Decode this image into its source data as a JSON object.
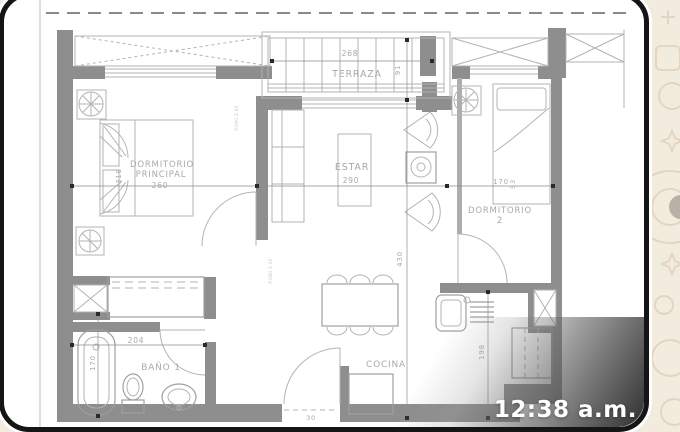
{
  "wallpaper": {
    "bg": "#f2ecdf",
    "doodle_color": "#e3d5c0",
    "accent_circle_color": "#b8b1a6"
  },
  "card": {
    "bg": "#ffffff",
    "border_color": "#151515"
  },
  "overlay": {
    "timestamp": "12:38 a.m.",
    "text_color": "#ffffff"
  },
  "plan": {
    "wall_color": "#8e8e8e",
    "label_color": "#a9a9a9",
    "rooms": [
      {
        "name": "DORMITORIO PRINCIPAL",
        "width_cm": "260",
        "depth_cm": "318"
      },
      {
        "name": "TERRAZA",
        "width_cm": "268",
        "depth_cm": "91"
      },
      {
        "name": "ESTAR",
        "width_cm": "290",
        "length_cm": "430"
      },
      {
        "name": "DORMITORIO 2",
        "width_cm": "170",
        "extra_cm": "53"
      },
      {
        "name": "BAÑO 1",
        "width_cm": "204",
        "depth_cm": "170"
      },
      {
        "name": "COCINA",
        "depth_cm": "198"
      }
    ],
    "labels": [
      {
        "id": "terraza-name",
        "t": "TERRAZA",
        "x": 357,
        "y": 77,
        "s": 9.5
      },
      {
        "id": "terraza-width",
        "t": "268",
        "x": 350,
        "y": 56,
        "s": 7.5
      },
      {
        "id": "terraza-depth",
        "t": "91",
        "x": 400,
        "y": 70,
        "s": 7,
        "r": -90
      },
      {
        "id": "dorm1-line1",
        "t": "DORMITORIO",
        "x": 162,
        "y": 167,
        "s": 8.5
      },
      {
        "id": "dorm1-line2",
        "t": "PRINCIPAL",
        "x": 161,
        "y": 177,
        "s": 8.5
      },
      {
        "id": "dorm1-width",
        "t": "260",
        "x": 160,
        "y": 188,
        "s": 7.5
      },
      {
        "id": "dorm1-depth",
        "t": "318",
        "x": 121,
        "y": 176,
        "s": 7,
        "r": -90
      },
      {
        "id": "estar-name",
        "t": "ESTAR",
        "x": 352,
        "y": 170,
        "s": 9.5
      },
      {
        "id": "estar-width",
        "t": "290",
        "x": 351,
        "y": 183,
        "s": 7.5
      },
      {
        "id": "dorm2-line1",
        "t": "DORMITORIO",
        "x": 500,
        "y": 213,
        "s": 8.5
      },
      {
        "id": "dorm2-line2",
        "t": "2",
        "x": 500,
        "y": 223,
        "s": 8.5
      },
      {
        "id": "dorm2-width",
        "t": "170",
        "x": 501,
        "y": 184,
        "s": 7
      },
      {
        "id": "dorm2-extra",
        "t": "53",
        "x": 515,
        "y": 184,
        "s": 6.5,
        "r": -90
      },
      {
        "id": "bano-name",
        "t": "BAÑO 1",
        "x": 161,
        "y": 370,
        "s": 9
      },
      {
        "id": "bano-width",
        "t": "204",
        "x": 136,
        "y": 343,
        "s": 7.5
      },
      {
        "id": "bano-depth",
        "t": "170",
        "x": 95,
        "y": 363,
        "s": 7,
        "r": -90
      },
      {
        "id": "cocina-name",
        "t": "COCINA",
        "x": 386,
        "y": 367,
        "s": 9
      },
      {
        "id": "cocina-depth",
        "t": "198",
        "x": 484,
        "y": 352,
        "s": 7,
        "r": -90
      },
      {
        "id": "estar-length",
        "t": "430",
        "x": 402,
        "y": 259,
        "s": 7,
        "r": -90
      },
      {
        "id": "entry-width",
        "t": "30",
        "x": 311,
        "y": 420,
        "s": 6.5
      },
      {
        "id": "door-tag-1",
        "t": "P.090 2.40",
        "x": 238,
        "y": 118,
        "s": 4.5,
        "r": -90,
        "f": 1
      },
      {
        "id": "door-tag-2",
        "t": "P.080 2.10",
        "x": 272,
        "y": 271,
        "s": 4.5,
        "r": -90,
        "f": 1
      }
    ]
  }
}
